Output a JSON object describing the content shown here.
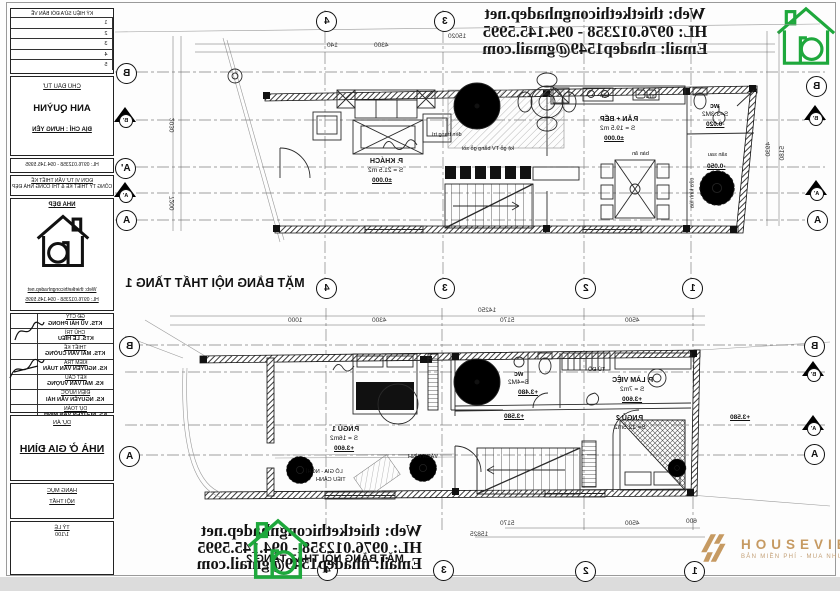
{
  "contact": {
    "web": "Web: thietkethicongnhadep.net",
    "hotline": "HL: 0976.012358 - 094.145.5995",
    "email": "Email: nhadep1549@gmail.com"
  },
  "plans": {
    "t1": "MẶT BẰNG NỘI THẤT TẦNG 1",
    "t2": "MẶT BẰNG NỘI THẤT TẦNG 2"
  },
  "title_block": {
    "revision": {
      "header": "KÝ HIỆU SỬA ĐỔI BẢN VẼ",
      "rows": [
        "1",
        "2",
        "3",
        "4",
        "5"
      ]
    },
    "investor": {
      "label": "CHỦ ĐẦU TƯ",
      "name": "ANH QUỲNH",
      "address": "ĐỊA CHỈ : HƯNG YÊN"
    },
    "unit": {
      "label": "ĐƠN VỊ TƯ VẤN THIẾT KẾ",
      "name": "CÔNG TY THIẾT KẾ & THI CÔNG NHÀ ĐẸP"
    },
    "logo_box": {
      "brand": "NHÀ ĐẸP"
    },
    "signatures": [
      {
        "role": "GĐ CTY",
        "name": "KTS. VŨ HẢI PHONG"
      },
      {
        "role": "CHỦ TRÌ",
        "name": "KTS. LÊ HIẾU"
      },
      {
        "role": "THIẾT KẾ",
        "name": "KTS. MAI VĂN CƯỜNG"
      },
      {
        "role": "KIỂM TRA",
        "name": "KS. NGUYỄN VĂN TUẤN"
      },
      {
        "role": "KẾT CẤU",
        "name": "KS. MAI VĂN VƯỢNG"
      },
      {
        "role": "ĐIỆN NƯỚC",
        "name": "KS. NGUYỄN VĂN HẢI"
      },
      {
        "role": "DỰ TOÁN",
        "name": "KS. NGUYỄN VĂN MINH"
      }
    ],
    "project": {
      "label": "DỰ ÁN",
      "name": "NHÀ Ở GIA ĐÌNH"
    },
    "extra": {
      "hang_muc": "HẠNG MỤC",
      "hang_muc_val": "NỘI THẤT",
      "ty_le": "TỶ LỆ",
      "ty_le_val": "1/100"
    }
  },
  "grid1": {
    "top": [
      "4",
      "3"
    ],
    "mid": [
      "4",
      "3",
      "2",
      "1"
    ],
    "left": [
      "B",
      "B'",
      "A'",
      "A'",
      "A"
    ],
    "right": [
      "B",
      "B'",
      "A'",
      "A"
    ]
  },
  "grid2": {
    "bottom": [
      "4",
      "3",
      "2",
      "1"
    ],
    "left": [
      "B",
      "A"
    ],
    "right": [
      "B",
      "B'",
      "A'",
      "A"
    ]
  },
  "dims1": {
    "top_small": "140",
    "top_seg": "4300",
    "top_total": "15020",
    "left_a": "2030",
    "left_b": "7200",
    "right_a": "4930",
    "right_b": "5180",
    "mid_total": "14250",
    "mid_1": "1000",
    "mid_2": "4300",
    "mid_3": "5170",
    "mid_4": "4500"
  },
  "dims2": {
    "bot_1": "5170",
    "bot_2": "4500",
    "bot_3": "600",
    "bot_total": "15825"
  },
  "rooms1": {
    "khach": {
      "name": "P. KHÁCH",
      "area": "S = 21.5 m2",
      "level": "±0.000"
    },
    "anbep": {
      "name": "P.ĂN + BẾP",
      "area": "S = 19.5 m2",
      "level": "±0.000"
    },
    "wc": {
      "name": "wc",
      "area": "S=3.3M2",
      "level": "-0.020"
    },
    "san": {
      "name": "sân sau",
      "level": "-0.050"
    },
    "ban_an": "bàn ăn",
    "bep": "bếp",
    "rua": "rửa",
    "ke_tv": "kệ gỗ TV bằng gỗ sồi",
    "den": "đèn trang trí",
    "cua_kinh": "cửa kính lùa"
  },
  "rooms2": {
    "ngu1": {
      "name": "P.NGỦ 1",
      "area": "S = 16m2",
      "level": "+3.600"
    },
    "ngu2": {
      "name": "P.NGỦ 2",
      "area": "S= 12.5m2"
    },
    "lamviec": {
      "name": "P. LÀM VIỆC",
      "area": "S = 7m2",
      "level": "+3.600"
    },
    "wc": {
      "name": "wc",
      "area": "S=4M2",
      "level": "+3.480"
    },
    "logia": {
      "line1": "LÔ GIA - NGHỈ",
      "line2": "TIỂU CẢNH"
    },
    "vach_kinh": "VÁCH KÍNH",
    "tu_do": "TỦ ĐỒ",
    "hall_level": "+3.580",
    "right_level": "+3.580"
  },
  "watermark": {
    "brand": "HOUSEVIET",
    "tagline": "BẢN MIỀN PHÍ - MUA NHƯ Ý"
  }
}
